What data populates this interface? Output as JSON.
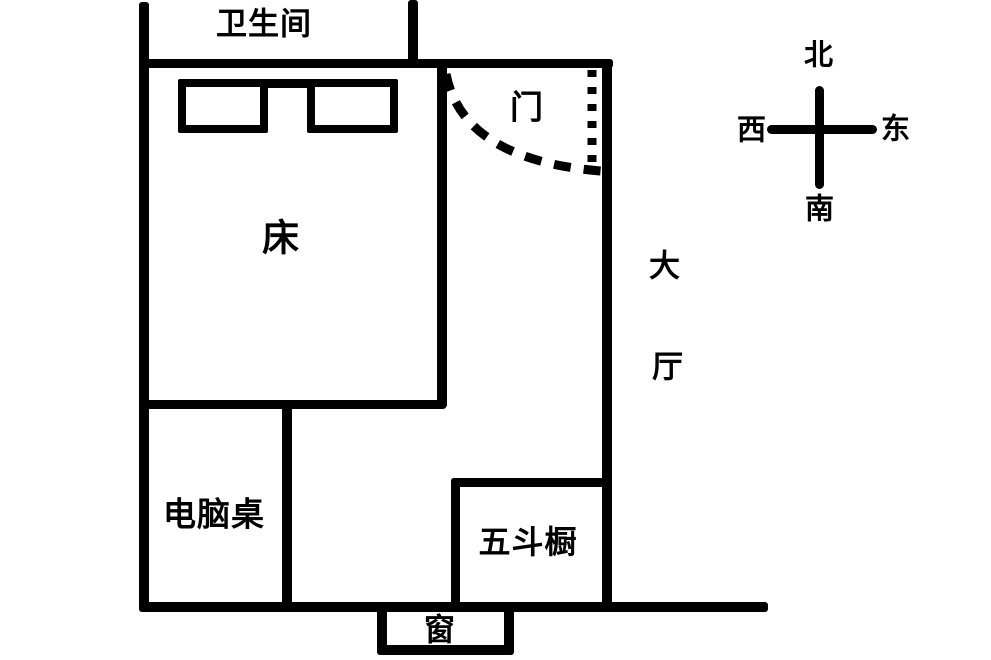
{
  "canvas": {
    "width": 991,
    "height": 660,
    "background_color": "#ffffff",
    "line_color": "#000000"
  },
  "rooms": {
    "bathroom": {
      "label": "卫生间"
    },
    "hall": {
      "label": "大厅",
      "char1": "大",
      "char2": "厅"
    }
  },
  "furniture": {
    "bed": {
      "label": "床"
    },
    "computer_desk": {
      "label": "电脑桌"
    },
    "chest_of_drawers": {
      "label": "五斗橱"
    }
  },
  "openings": {
    "door": {
      "label": "门"
    },
    "window": {
      "label": "窗"
    }
  },
  "compass": {
    "north": "北",
    "south": "南",
    "east": "东",
    "west": "西"
  }
}
